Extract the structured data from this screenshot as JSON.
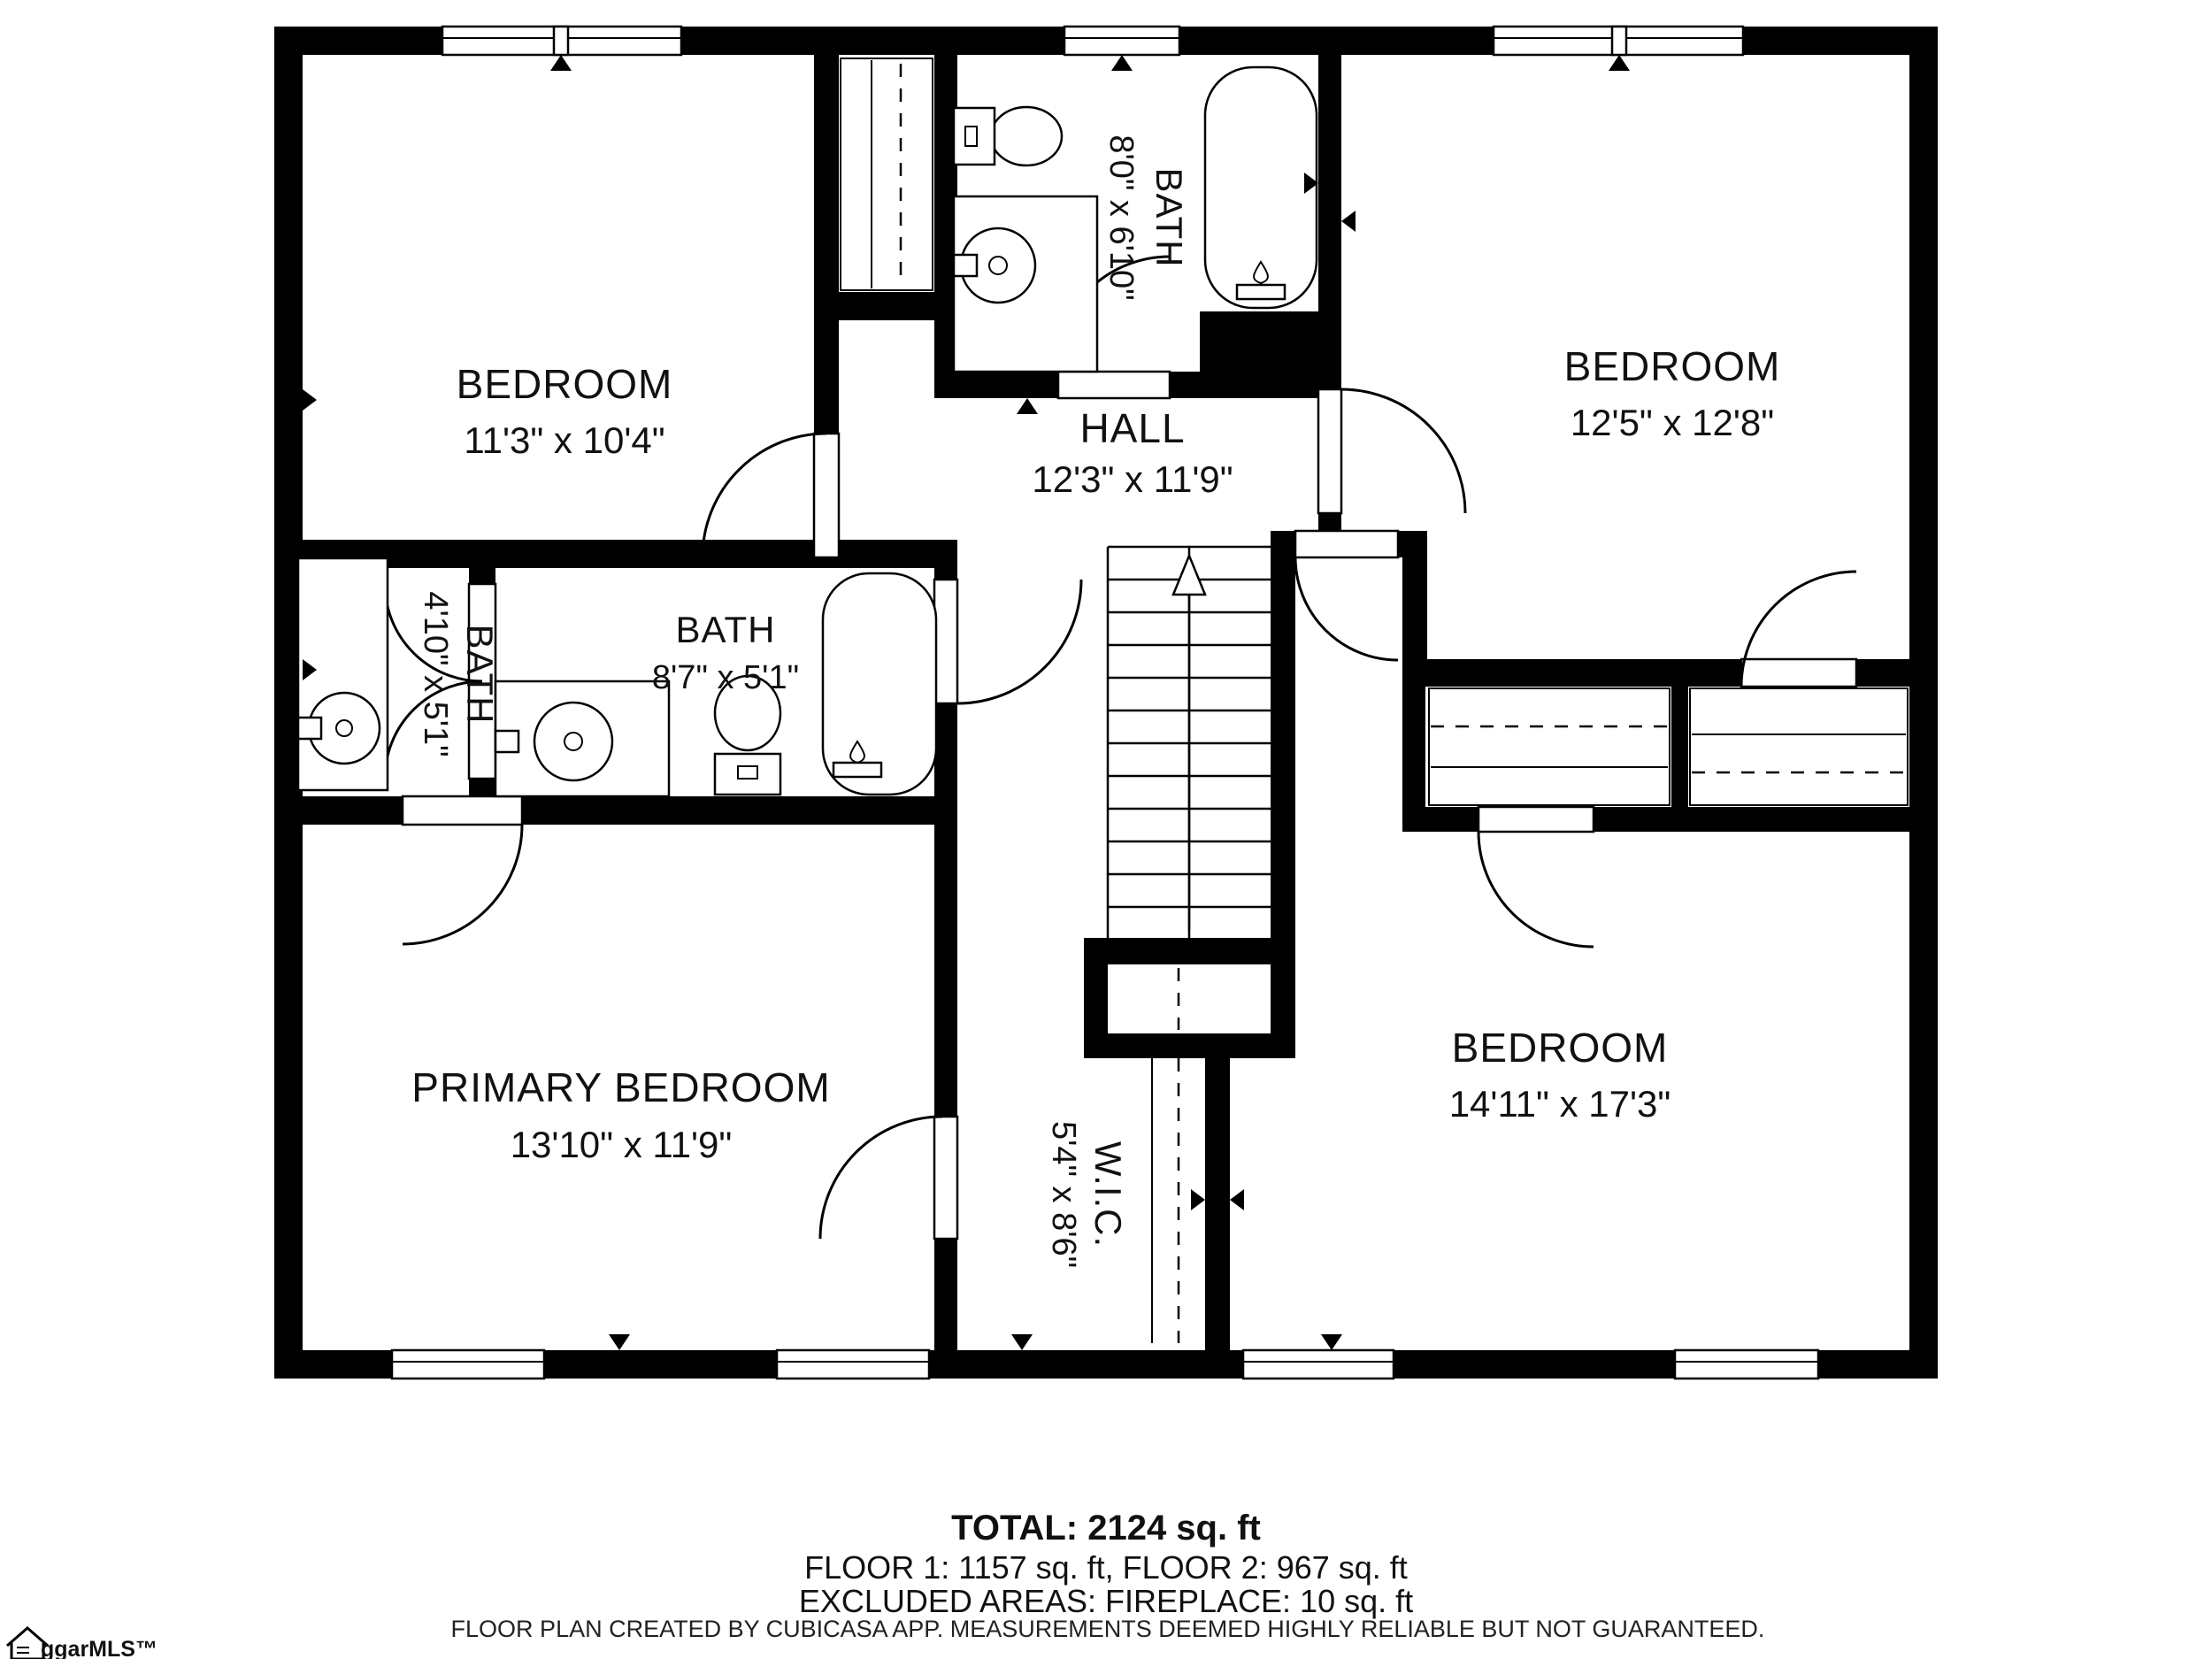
{
  "floorplan": {
    "rooms": [
      {
        "id": "bedroom-top-left",
        "name": "BEDROOM",
        "dims": "11'3\" x 10'4\""
      },
      {
        "id": "bath-top",
        "name": "BATH",
        "dims": "8'0\" x 6'10\""
      },
      {
        "id": "hall",
        "name": "HALL",
        "dims": "12'3\" x 11'9\""
      },
      {
        "id": "bedroom-top-right",
        "name": "BEDROOM",
        "dims": "12'5\" x 12'8\""
      },
      {
        "id": "bath-left",
        "name": "BATH",
        "dims": "4'10\" x 5'1\""
      },
      {
        "id": "bath-middle",
        "name": "BATH",
        "dims": "8'7\" x 5'1\""
      },
      {
        "id": "primary-bedroom",
        "name": "PRIMARY BEDROOM",
        "dims": "13'10\" x 11'9\""
      },
      {
        "id": "walk-in-closet",
        "name": "W.I.C.",
        "dims": "5'4\" x 8'6\""
      },
      {
        "id": "bedroom-bottom-right",
        "name": "BEDROOM",
        "dims": "14'11\" x 17'3\""
      }
    ],
    "summary": {
      "total": "TOTAL: 2124 sq. ft",
      "floors": "FLOOR 1: 1157 sq. ft, FLOOR 2: 967 sq. ft",
      "excluded": "EXCLUDED AREAS: FIREPLACE: 10 sq. ft"
    },
    "disclaimer": "FLOOR PLAN CREATED BY CUBICASA APP. MEASUREMENTS DEEMED HIGHLY RELIABLE BUT NOT GUARANTEED.",
    "logo": "ggarMLS™",
    "colors": {
      "wall": "#000000",
      "background": "#ffffff",
      "text": "#111111"
    }
  }
}
